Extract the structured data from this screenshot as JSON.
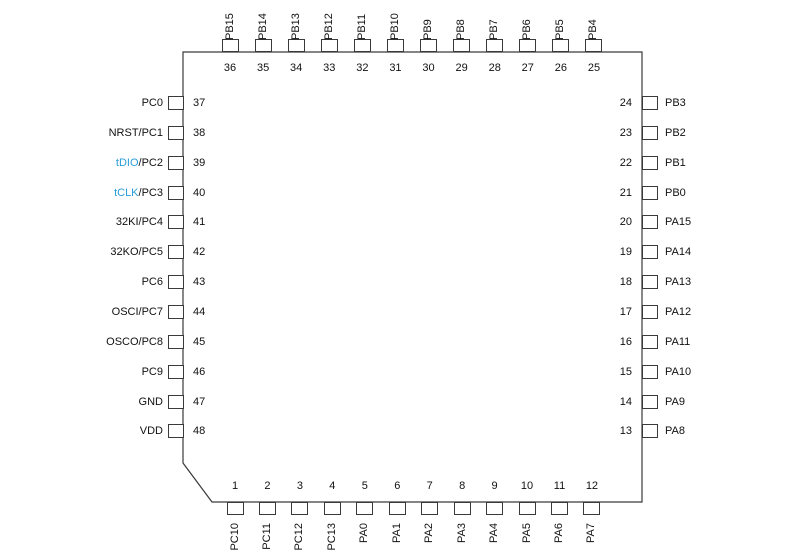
{
  "diagram": {
    "type": "ic-pinout-48-pin-quad-package",
    "colors": {
      "line": "#3a3a3a",
      "text": "#111111",
      "signal_blue": "#2a9cd8"
    },
    "sides": {
      "top": [
        {
          "number": "36",
          "label": "PB15"
        },
        {
          "number": "35",
          "label": "PB14"
        },
        {
          "number": "34",
          "label": "PB13"
        },
        {
          "number": "33",
          "label": "PB12"
        },
        {
          "number": "32",
          "label": "PB11"
        },
        {
          "number": "31",
          "label": "PB10"
        },
        {
          "number": "30",
          "label": "PB9"
        },
        {
          "number": "29",
          "label": "PB8"
        },
        {
          "number": "28",
          "label": "PB7"
        },
        {
          "number": "27",
          "label": "PB6"
        },
        {
          "number": "26",
          "label": "PB5"
        },
        {
          "number": "25",
          "label": "PB4"
        }
      ],
      "left": [
        {
          "number": "37",
          "alt": "",
          "label": "PC0"
        },
        {
          "number": "38",
          "alt": "",
          "label": "NRST/PC1"
        },
        {
          "number": "39",
          "alt": "tDIO",
          "label": "/PC2"
        },
        {
          "number": "40",
          "alt": "tCLK",
          "label": "/PC3"
        },
        {
          "number": "41",
          "alt": "",
          "label": "32KI/PC4"
        },
        {
          "number": "42",
          "alt": "",
          "label": "32KO/PC5"
        },
        {
          "number": "43",
          "alt": "",
          "label": "PC6"
        },
        {
          "number": "44",
          "alt": "",
          "label": "OSCI/PC7"
        },
        {
          "number": "45",
          "alt": "",
          "label": "OSCO/PC8"
        },
        {
          "number": "46",
          "alt": "",
          "label": "PC9"
        },
        {
          "number": "47",
          "alt": "",
          "label": "GND"
        },
        {
          "number": "48",
          "alt": "",
          "label": "VDD"
        }
      ],
      "right": [
        {
          "number": "24",
          "label": "PB3"
        },
        {
          "number": "23",
          "label": "PB2"
        },
        {
          "number": "22",
          "label": "PB1"
        },
        {
          "number": "21",
          "label": "PB0"
        },
        {
          "number": "20",
          "label": "PA15"
        },
        {
          "number": "19",
          "label": "PA14"
        },
        {
          "number": "18",
          "label": "PA13"
        },
        {
          "number": "17",
          "label": "PA12"
        },
        {
          "number": "16",
          "label": "PA11"
        },
        {
          "number": "15",
          "label": "PA10"
        },
        {
          "number": "14",
          "label": "PA9"
        },
        {
          "number": "13",
          "label": "PA8"
        }
      ],
      "bottom": [
        {
          "number": "1",
          "label": "PC10"
        },
        {
          "number": "2",
          "label": "PC11"
        },
        {
          "number": "3",
          "label": "PC12"
        },
        {
          "number": "4",
          "label": "PC13"
        },
        {
          "number": "5",
          "label": "PA0"
        },
        {
          "number": "6",
          "label": "PA1"
        },
        {
          "number": "7",
          "label": "PA2"
        },
        {
          "number": "8",
          "label": "PA3"
        },
        {
          "number": "9",
          "label": "PA4"
        },
        {
          "number": "10",
          "label": "PA5"
        },
        {
          "number": "11",
          "label": "PA6"
        },
        {
          "number": "12",
          "label": "PA7"
        }
      ]
    }
  }
}
